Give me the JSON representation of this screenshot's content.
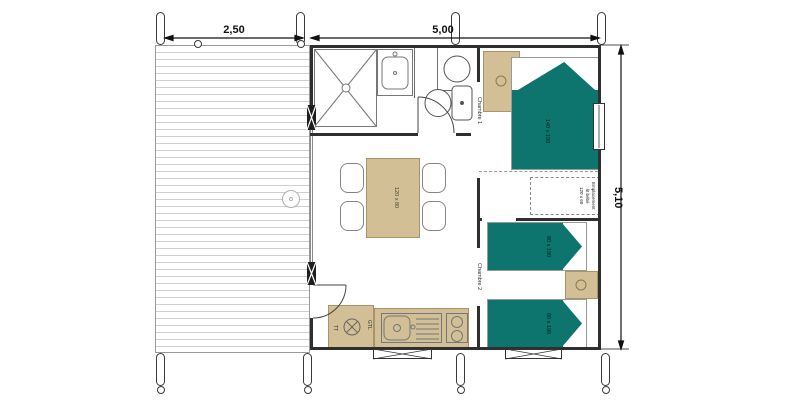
{
  "plan": {
    "title": "lodge-floor-plan",
    "dimensions": {
      "terrace_width": "2,50",
      "building_width": "5,00",
      "building_depth": "5,10"
    },
    "rooms": {
      "bedroom1": "Chambre 1",
      "bedroom2": "Chambre 2"
    },
    "furniture": {
      "double_bed_size": "140 x 190",
      "single_bed_top_size": "80 x 190",
      "single_bed_bottom_size": "80 x 190",
      "table_size": "120 x 80",
      "baby_bed": {
        "line1": "Emplacement",
        "line2": "lit bébé",
        "line3": "120 x 60"
      }
    },
    "equipment": {
      "water_heater": "CE",
      "gtl": "GTL",
      "tt": "TT"
    },
    "colors": {
      "bed": "#0e756e",
      "wood": "#d2bf96",
      "wall": "#2f2f2f"
    }
  }
}
